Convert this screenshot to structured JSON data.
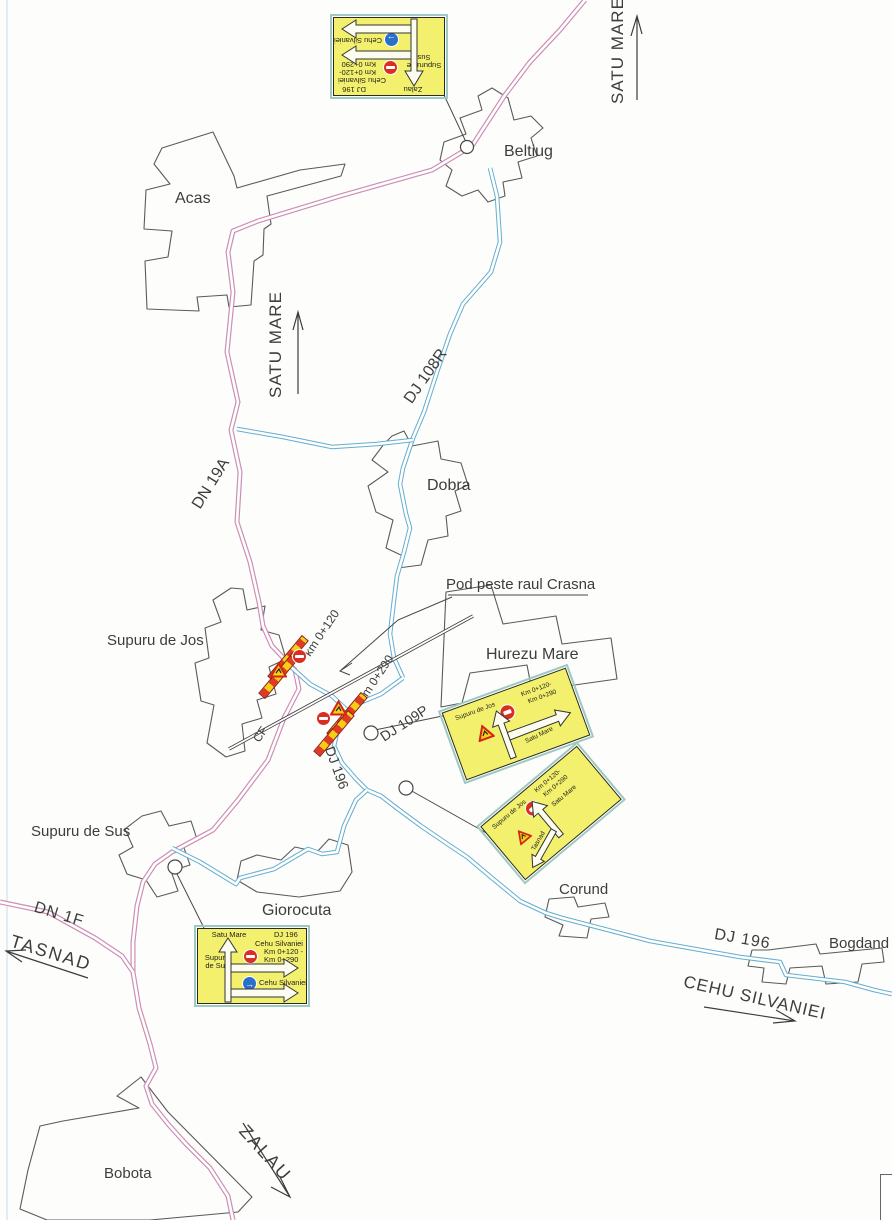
{
  "colors": {
    "road-pink": "#cc8fb4",
    "road-blue": "#64aecf",
    "sign-yellow": "#f3f06d",
    "sign-border-outer": "#9ec9c2",
    "no-entry-red": "#d92f23",
    "mandatory-blue": "#2a6fc9",
    "barrier-red": "#e03a22",
    "barrier-yellow": "#f7ce14"
  },
  "labels": {
    "satu_mare_top": "SATU MARE",
    "satu_mare_mid": "SATU MARE",
    "beltiug": "Beltiug",
    "acas": "Acas",
    "dobra": "Dobra",
    "hurezu_mare": "Hurezu Mare",
    "supuru_de_jos": "Supuru de Jos",
    "supuru_de_sus": "Supuru de Sus",
    "giorocuta": "Giorocuta",
    "corund": "Corund",
    "bogdand": "Bogdand",
    "bobota": "Bobota",
    "dn19a": "DN 19A",
    "dj108r": "DJ 108R",
    "dj109p": "DJ 109P",
    "dj196_mid": "DJ 196",
    "dj196_east": "DJ 196",
    "dn1f": "DN 1F",
    "cf": "CF",
    "tasnad": "TASNAD",
    "zalau": "ZALAU",
    "cehu_silvaniei": "CEHU SILVANIEI",
    "km_0_120": "km 0+120",
    "km_0_290": "Km 0+290",
    "pod": "Pod peste raul Crasna"
  },
  "signs": {
    "north": {
      "ahead": "Zalau",
      "side": "Supuru de Sus",
      "route": "DJ 196",
      "closed_dest": "Cehu Silvaniei",
      "km1": "Km 0+120-",
      "km2": "Km 0+290",
      "detour_dest": "Cehu Silvaniei"
    },
    "hurezu": {
      "place": "Supuru de Jos",
      "km1": "Km 0+120-",
      "km2": "Km 0+290",
      "branch": "Satu Mare"
    },
    "corund": {
      "place": "Supuru de Jos",
      "km1": "Km 0+120-",
      "km2": "Km 0+290",
      "up": "Satu Mare",
      "down": "Tasnad"
    },
    "giorocuta": {
      "ahead": "Satu Mare",
      "route": "DJ 196",
      "closed_dest": "Cehu Silvaniei",
      "km1": "Km 0+120 -",
      "km2": "Km 0+290",
      "side": "Supuru de Sus",
      "detour_dest": "Cehu Silvaniei"
    }
  }
}
